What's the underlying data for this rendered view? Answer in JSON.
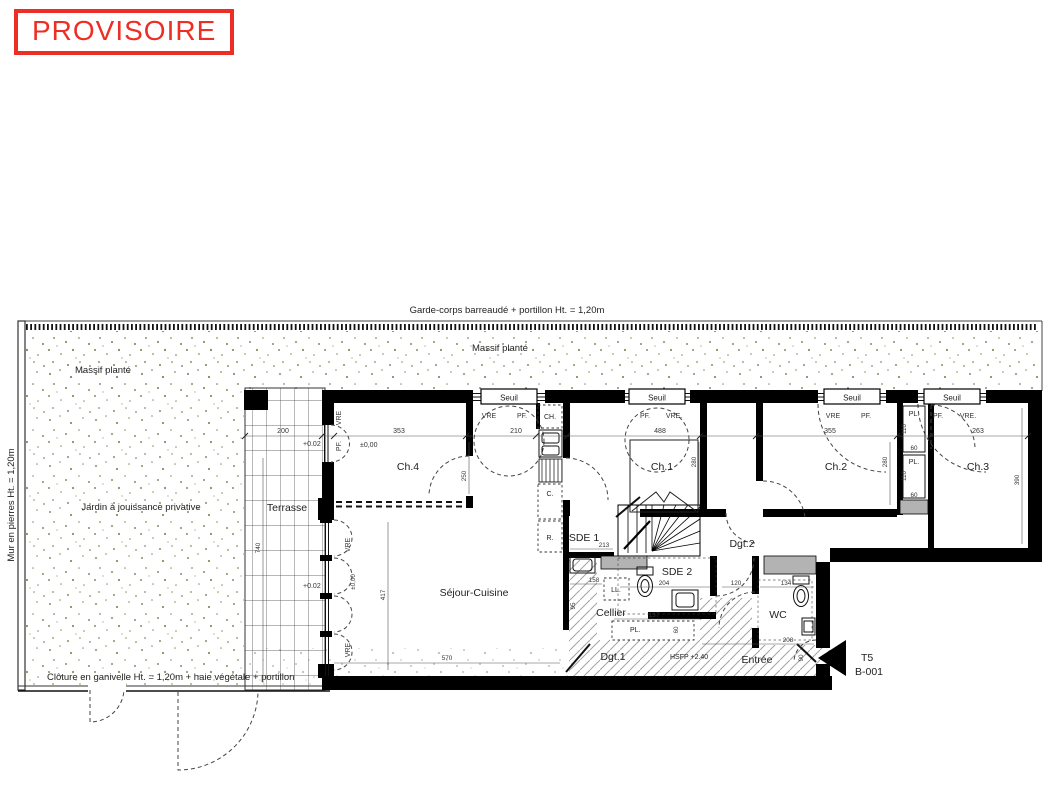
{
  "stamp": {
    "label": "PROVISOIRE",
    "color": "#ee2e24"
  },
  "site": {
    "garde_corps": "Garde-corps barreaudé + portillon Ht. = 1,20m",
    "massif_top": "Massif planté",
    "massif_left": "Massif planté",
    "mur_pierres": "Mur en pierres Ht. = 1,20m",
    "jardin": "Jardin à jouissance privative",
    "cloture": "Clôture en ganivelle Ht. = 1,20m + haie végétale + portillon"
  },
  "rooms": {
    "terrasse": "Terrasse",
    "ch4": "Ch.4",
    "ch1": "Ch.1",
    "ch2": "Ch.2",
    "ch3": "Ch.3",
    "sejour": "Séjour-Cuisine",
    "sde1": "SDE 1",
    "sde2": "SDE 2",
    "dgt1": "Dgt.1",
    "dgt2": "Dgt.2",
    "cellier": "Cellier",
    "wc": "WC",
    "entree": "Entrée"
  },
  "fixtures": {
    "ch": "CH.",
    "c": "C.",
    "r": "R.",
    "ll": "LL.",
    "pl": "PL."
  },
  "openings": {
    "seuil": "Seuil",
    "vre": "VRE",
    "vre_dot": "VRE.",
    "pf": "PF."
  },
  "levels": {
    "terrace": "+0.02",
    "ground": "±0,00",
    "hsfp": "HSFP +2.40"
  },
  "unit": {
    "type": "T5",
    "code": "B-001"
  },
  "dims": {
    "d200": "200",
    "d353": "353",
    "d210": "210",
    "d488": "488",
    "d355": "355",
    "d263": "263",
    "d250": "250",
    "d280": "280",
    "d390": "390",
    "d570": "570",
    "d417": "417",
    "d740": "740",
    "d213": "213",
    "d204": "204",
    "d158": "158",
    "d137": "137",
    "d120": "120",
    "d134": "134",
    "d208": "208",
    "d90": "90",
    "d110": "110",
    "d60": "60",
    "d95": "95"
  }
}
